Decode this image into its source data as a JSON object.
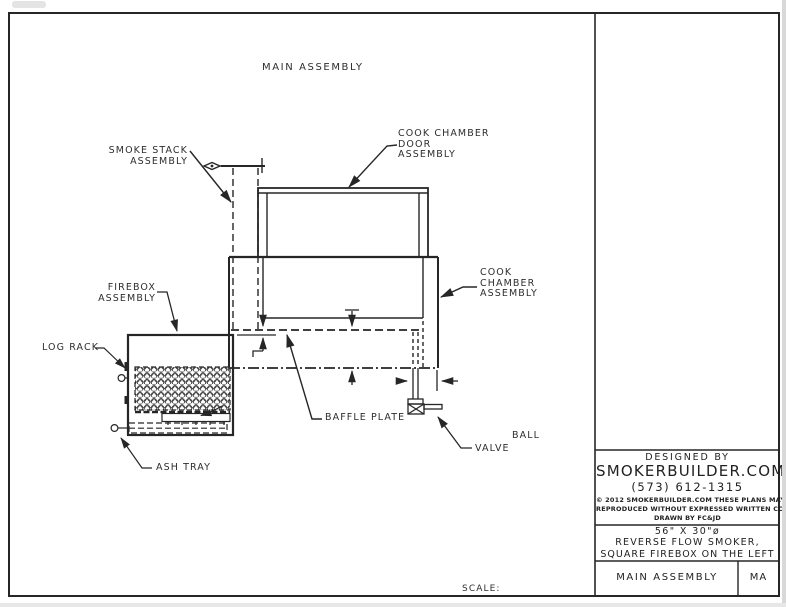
{
  "drawing": {
    "title": "MAIN ASSEMBLY",
    "scale_label": "SCALE:",
    "labels": {
      "smoke_stack_line1": "SMOKE STACK",
      "smoke_stack_line2": "ASSEMBLY",
      "door_line1": "COOK CHAMBER",
      "door_line2": "DOOR",
      "door_line3": "ASSEMBLY",
      "chamber_line1": "COOK",
      "chamber_line2": "CHAMBER",
      "chamber_line3": "ASSEMBLY",
      "firebox_line1": "FIREBOX",
      "firebox_line2": "ASSEMBLY",
      "log_rack": "LOG RACK",
      "baffle_plate": "BAFFLE PLATE",
      "ball_valve_line1": "BALL",
      "ball_valve_line2": "VALVE",
      "ash_tray": "ASH TRAY"
    }
  },
  "title_block": {
    "designed_by": "DESIGNED BY",
    "company": "SMOKERBUILDER.COM",
    "phone": "(573) 612-1315",
    "copyright_line1": "© 2012 SMOKERBUILDER.COM THESE PLANS MAY NOT BE",
    "copyright_line2": "REPRODUCED WITHOUT EXPRESSED WRITTEN CONSENT.",
    "copyright_line3": "DRAWN BY FC&JD",
    "size_spec": "56\" X 30\"ø",
    "description_line1": "REVERSE FLOW SMOKER,",
    "description_line2": "SQUARE FIREBOX ON THE LEFT",
    "sheet_name": "MAIN ASSEMBLY",
    "sheet_code": "MA"
  },
  "colors": {
    "line": "#262626",
    "text": "#2e2e2e"
  }
}
